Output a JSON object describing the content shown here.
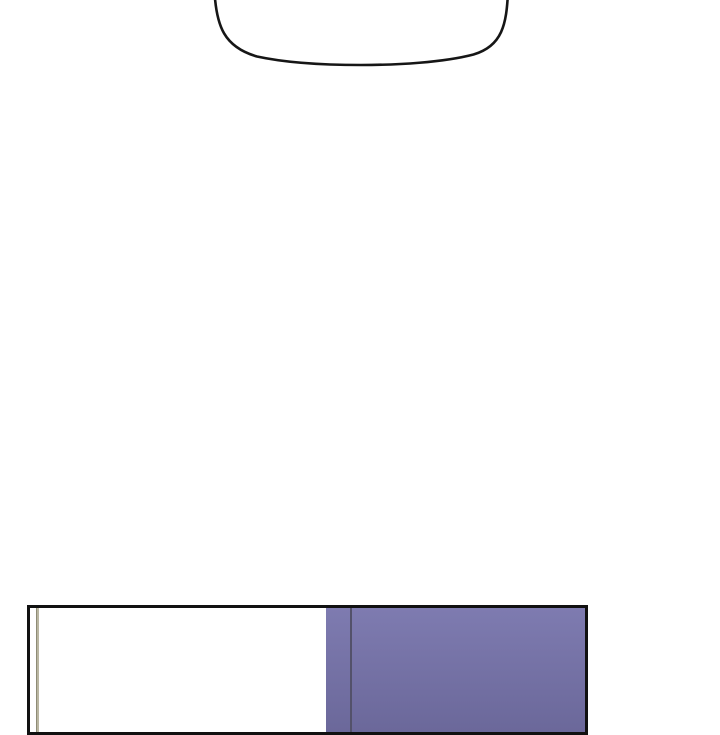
{
  "canvas": {
    "width": 720,
    "height": 700,
    "background": "#ffffff"
  },
  "speech_bubble": {
    "stroke": "#161616",
    "fill": "#ffffff",
    "stroke_width": "2.6"
  },
  "panel": {
    "border_color": "#111111",
    "background": "#ffffff",
    "purple_top": "#7e7bb0",
    "purple_bottom": "#6b689a",
    "seam_line_color": "#53516a",
    "accent_line_color": "#b9b6a1",
    "accent_edge_color": "#8e8b76"
  }
}
